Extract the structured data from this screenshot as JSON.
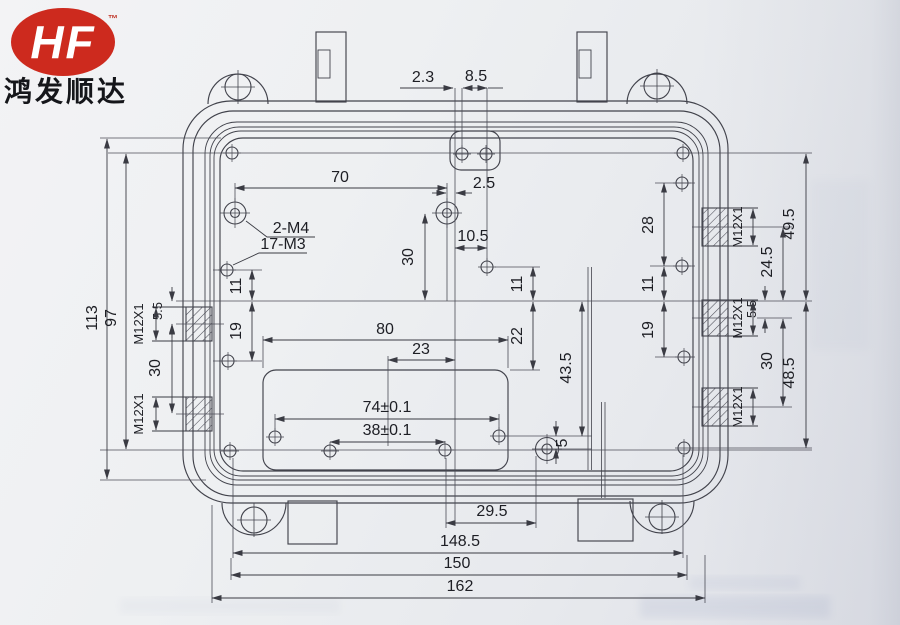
{
  "logo": {
    "brand": "HF",
    "trademark": "™",
    "company": "鸿发顺达"
  },
  "colors": {
    "logo_red": "#cd2a1e",
    "line": "#42434c",
    "paper": "#eceef0"
  },
  "dims": {
    "d2_3": "2.3",
    "d8_5": "8.5",
    "d70": "70",
    "d2_5": "2.5",
    "label_2m4": "2-M4",
    "label_17m3": "17-M3",
    "d30": "30",
    "d10_5": "10.5",
    "d11": "11",
    "d19": "19",
    "d22": "22",
    "d28": "28",
    "d23": "23",
    "d80": "80",
    "d43_5": "43.5",
    "d74": "74±0.1",
    "d38": "38±0.1",
    "d5": "5",
    "d5_5": "5.5",
    "m12x1": "M12X1",
    "d24_5": "24.5",
    "d49_5": "49.5",
    "d48_5": "48.5",
    "d29_5": "29.5",
    "d148_5": "148.5",
    "d150": "150",
    "d162": "162",
    "d97": "97",
    "d113": "113"
  }
}
